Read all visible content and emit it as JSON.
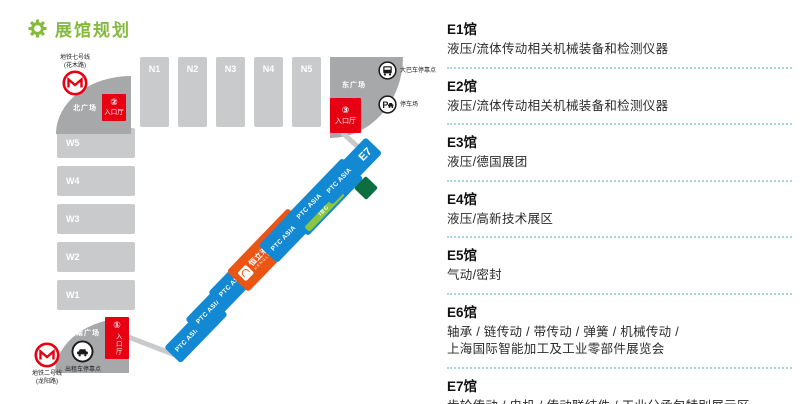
{
  "title": {
    "text": "展馆规划"
  },
  "map": {
    "north_halls": [
      "N1",
      "N2",
      "N3",
      "N4",
      "N5"
    ],
    "west_halls": [
      "W5",
      "W4",
      "W3",
      "W2",
      "W1"
    ],
    "east_halls": {
      "brand_label": "PTC ASIA",
      "halls": [
        "E1",
        "E2",
        "E3",
        "E4",
        "E5",
        "E6",
        "E7"
      ],
      "e4_brand": {
        "name": "恒立液压",
        "sub": "HENGLI"
      },
      "e6_stripe": "IBC"
    },
    "plazas": {
      "north": "北广场",
      "east": "东广场",
      "south": "南广场"
    },
    "entrances": {
      "hall_label": "入口厅",
      "no1": "①",
      "no2": "②",
      "no3": "③"
    },
    "transport": {
      "metro7": "地铁七号线\n(花木路)",
      "metro2": "地铁二号线\n(龙阳路)",
      "bus": "大巴车停靠点",
      "parking": "停车场",
      "taxi": "出租车停靠点",
      "parking_glyph": "P"
    }
  },
  "legend": {
    "entries": [
      {
        "hall": "E1馆",
        "desc": "液压/流体传动相关机械装备和检测仪器"
      },
      {
        "hall": "E2馆",
        "desc": "液压/流体传动相关机械装备和检测仪器"
      },
      {
        "hall": "E3馆",
        "desc": "液压/德国展团"
      },
      {
        "hall": "E4馆",
        "desc": "液压/高新技术展区"
      },
      {
        "hall": "E5馆",
        "desc": "气动/密封"
      },
      {
        "hall": "E6馆",
        "desc": "轴承 / 链传动 / 带传动 / 弹簧 / 机械传动 /\n上海国际智能加工及工业零部件展览会"
      },
      {
        "hall": "E7馆",
        "desc": "齿轮传动 / 电机 / 传动联结件 / 工业分承包特别展示区"
      }
    ]
  }
}
